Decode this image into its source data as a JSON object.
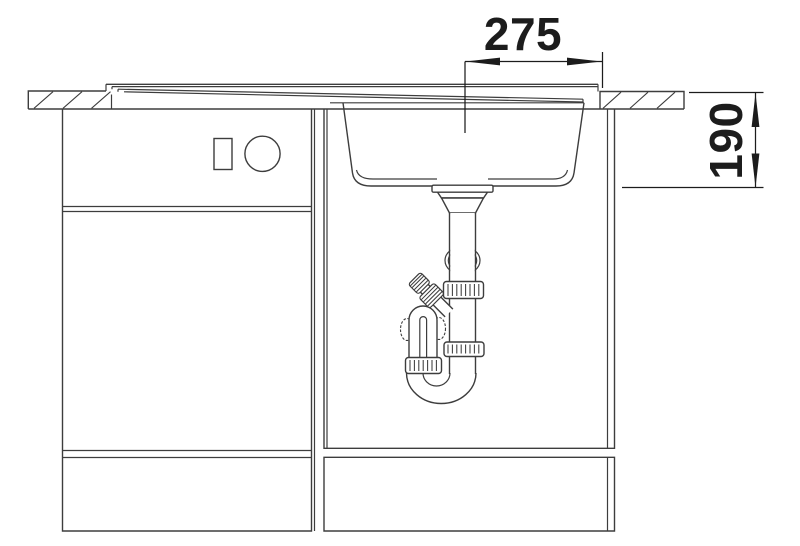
{
  "drawing": {
    "kind": "sink-installation-section",
    "labels": {
      "width": "275",
      "depth": "190"
    },
    "colors": {
      "line": "#3d3d3d",
      "dimension": "#1c1c1c",
      "background": "#ffffff"
    }
  }
}
